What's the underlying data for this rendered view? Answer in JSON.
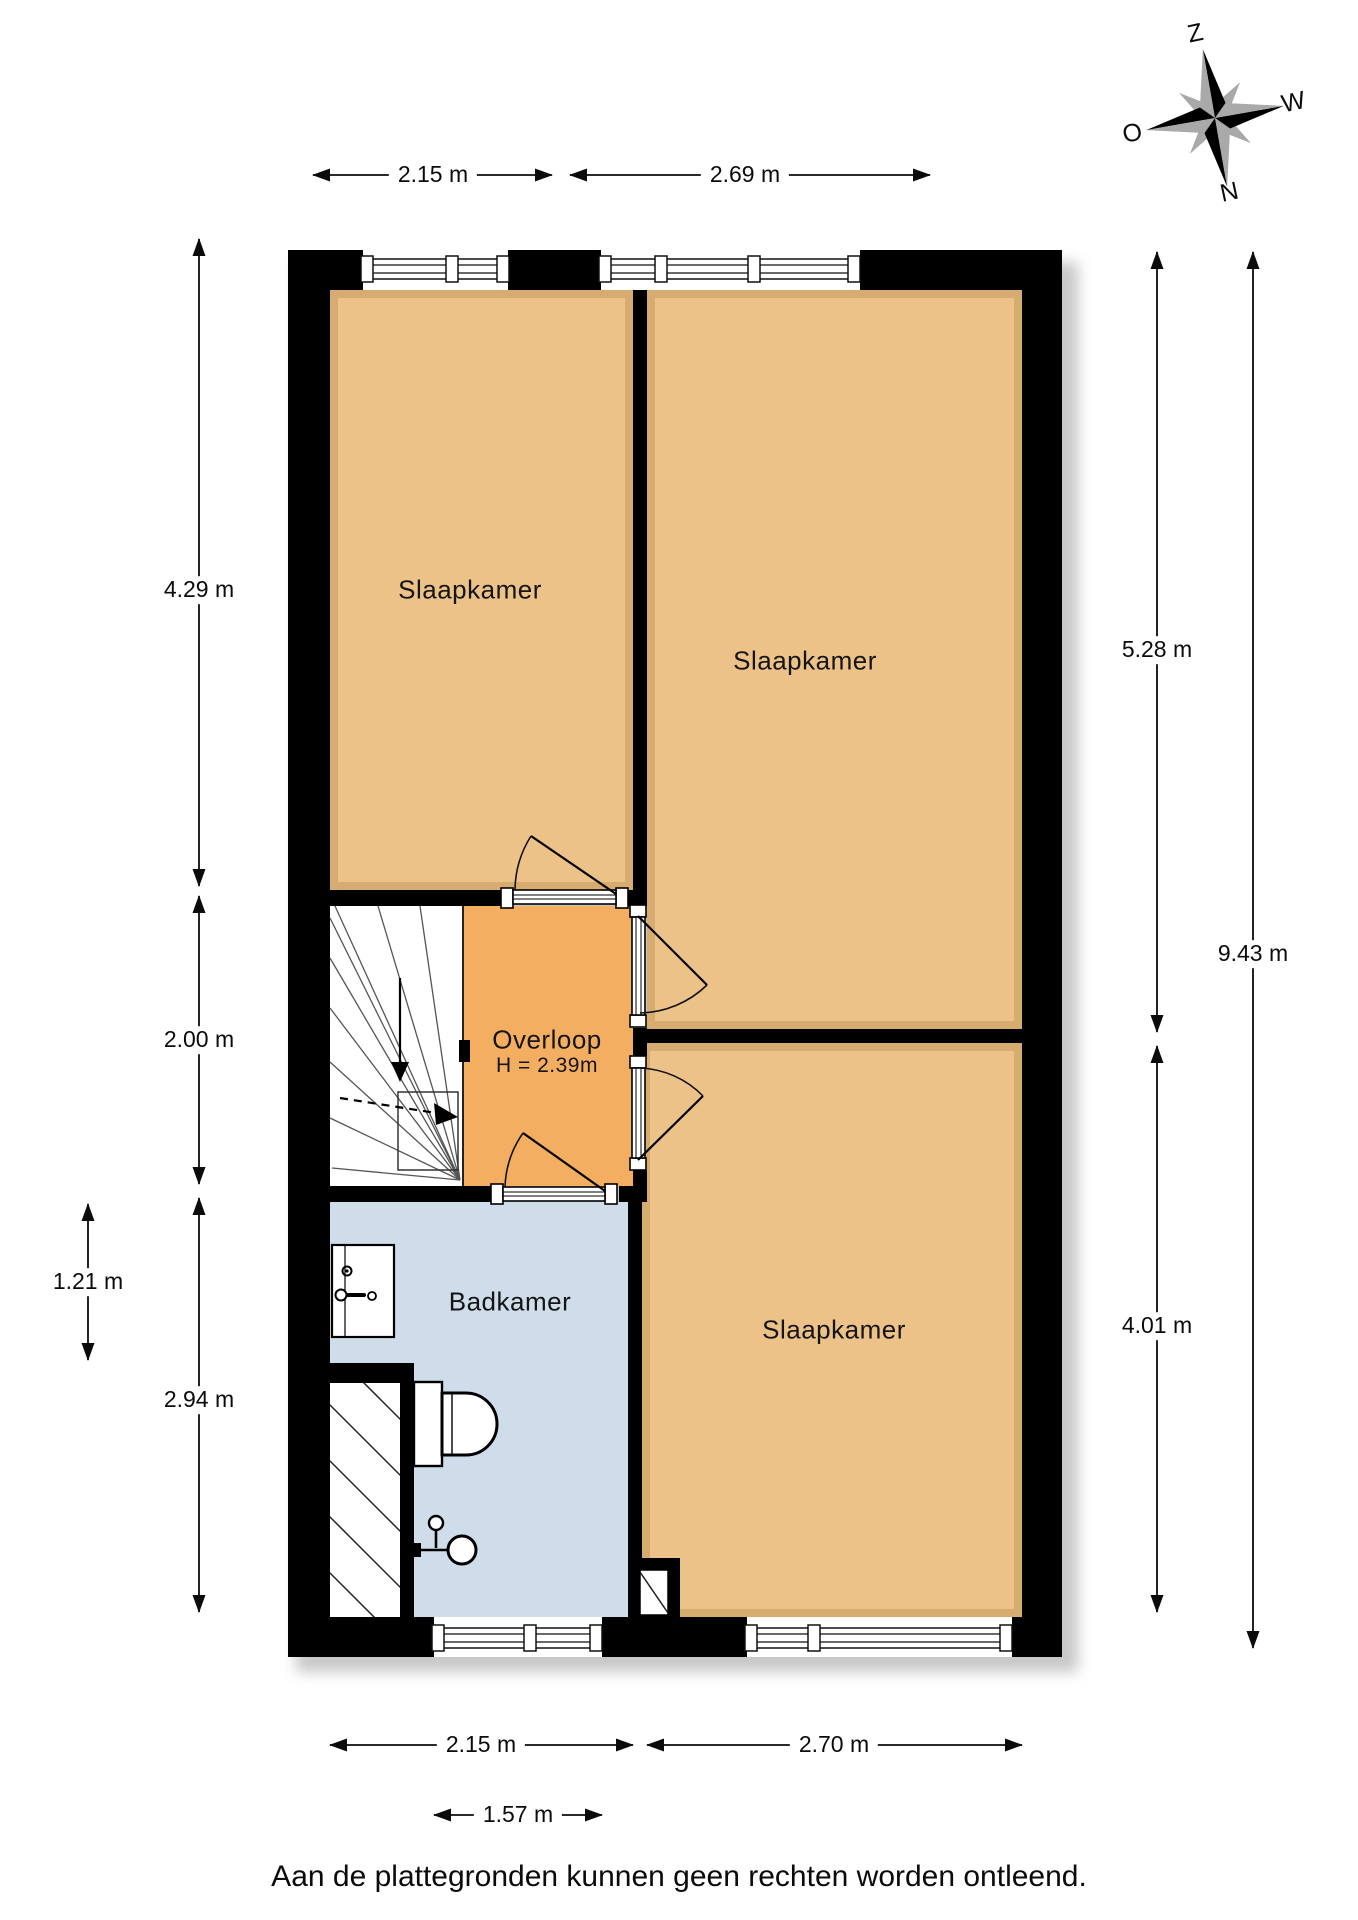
{
  "page": {
    "disclaimer": "Aan de plattegronden kunnen geen rechten worden ontleend."
  },
  "compass": {
    "top": "Z",
    "right": "W",
    "bottom": "N",
    "left": "O"
  },
  "rooms": {
    "bedroom_top_left": {
      "label": "Slaapkamer"
    },
    "bedroom_top_right": {
      "label": "Slaapkamer"
    },
    "bedroom_bottom_right": {
      "label": "Slaapkamer"
    },
    "landing": {
      "label": "Overloop",
      "ceiling_height": "H = 2.39m"
    },
    "bathroom": {
      "label": "Badkamer"
    }
  },
  "dimensions": {
    "top": {
      "d1": "2.15 m",
      "d2": "2.69 m"
    },
    "left": {
      "d1": "4.29 m",
      "d2": "2.00 m",
      "d3": "1.21 m",
      "d4": "2.94 m"
    },
    "right": {
      "d1": "5.28 m",
      "d2": "9.43 m",
      "d3": "4.01 m"
    },
    "bottom": {
      "d1": "2.15 m",
      "d2": "2.70 m",
      "d3": "1.57 m"
    }
  },
  "colors": {
    "wall": "#000000",
    "bedroom_floor": "#ecc288",
    "landing_floor": "#f3ae61",
    "bathroom_floor": "#cfdcea",
    "compass_gray": "#a9a9a9"
  }
}
